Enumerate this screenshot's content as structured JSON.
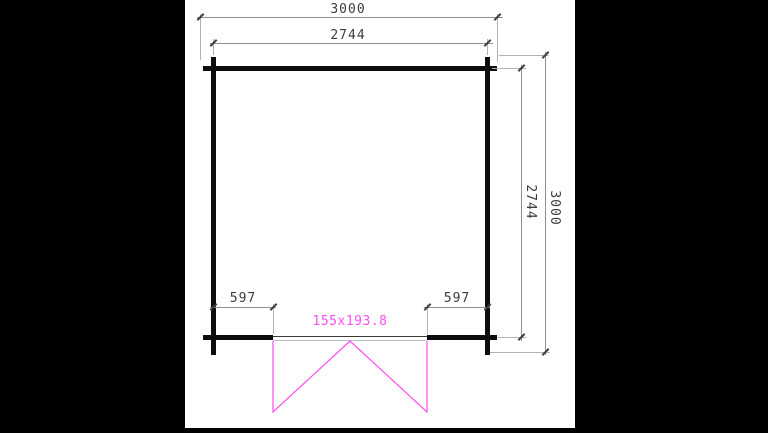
{
  "drawing": {
    "type": "floor-plan",
    "dimensions": {
      "top_outer": "3000",
      "top_inner": "2744",
      "right_outer": "3000",
      "right_inner": "2744",
      "bottom_left_offset": "597",
      "bottom_right_offset": "597",
      "door_size": "155x193.8"
    },
    "colors": {
      "background": "#000000",
      "paper": "#ffffff",
      "wall": "#0d0d0d",
      "dimension_line": "#8f8f8f",
      "extension_line": "#b3b3b3",
      "dimension_text": "#3c3c3c",
      "door_accent": "#ff4df2"
    }
  }
}
